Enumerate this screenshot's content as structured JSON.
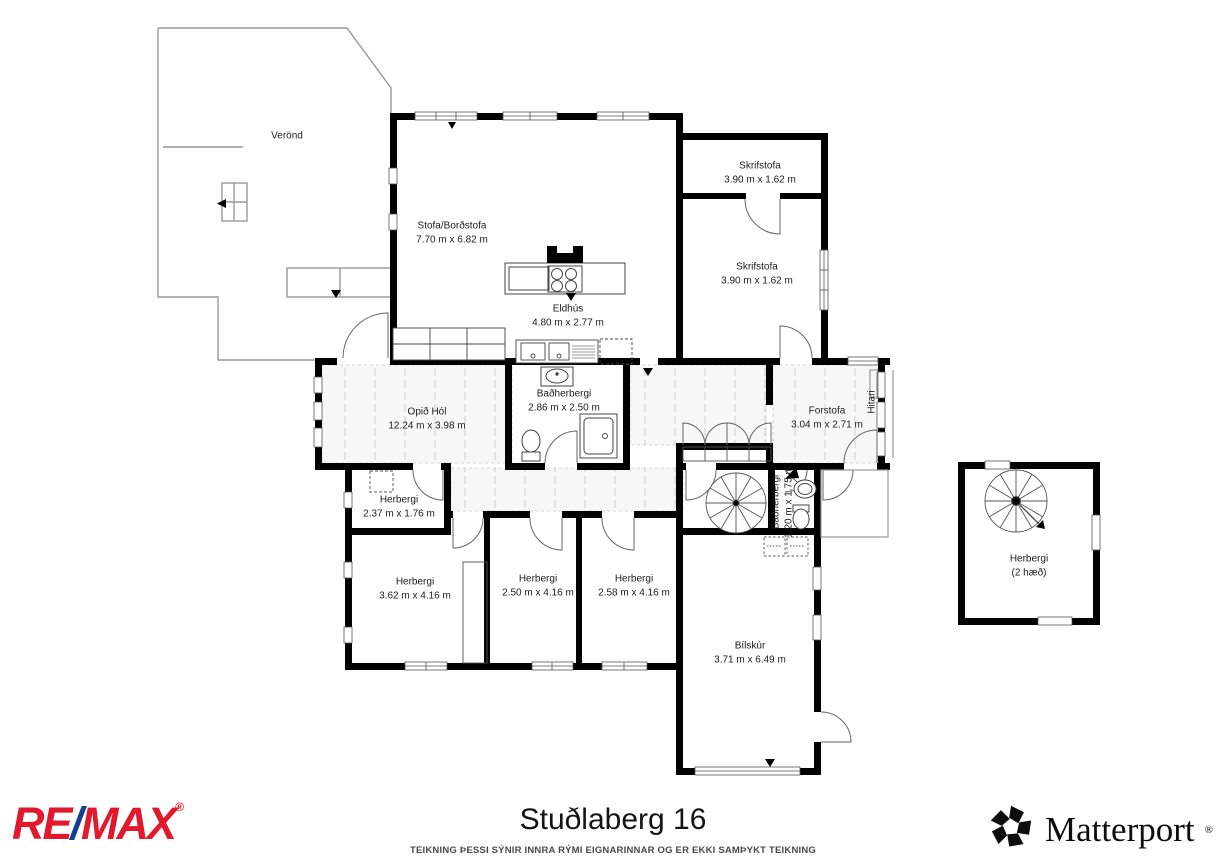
{
  "plan": {
    "rooms": {
      "verond": {
        "name": "Verönd"
      },
      "stofa": {
        "name": "Stofa/Borðstofa",
        "dims": "7.70 m x 6.82 m"
      },
      "skrifstofa1": {
        "name": "Skrifstofa",
        "dims": "3.90 m x 1.62 m"
      },
      "skrifstofa2": {
        "name": "Skrifstofa",
        "dims": "3.90 m x 1.62 m"
      },
      "eldhus": {
        "name": "Eldhús",
        "dims": "4.80 m x 2.77 m"
      },
      "opid_hol": {
        "name": "Opið Hól",
        "dims": "12.24 m x 3.98 m"
      },
      "badherbergi": {
        "name": "Baðherbergi",
        "dims": "2.86 m x 2.50 m"
      },
      "forstofa": {
        "name": "Forstofa",
        "dims": "3.04 m x 2.71 m"
      },
      "hitari": {
        "name": "Hitari"
      },
      "herbergi_small": {
        "name": "Herbergi",
        "dims": "2.37 m x 1.76 m"
      },
      "herbergi1": {
        "name": "Herbergi",
        "dims": "3.62 m x 4.16 m"
      },
      "herbergi2": {
        "name": "Herbergi",
        "dims": "2.50 m x 4.16 m"
      },
      "herbergi3": {
        "name": "Herbergi",
        "dims": "2.58 m x 4.16 m"
      },
      "badherbergi_small": {
        "name": "Baðherbergi",
        "dims": "1.20 m x 1.75 m"
      },
      "bilskur": {
        "name": "Bílskúr",
        "dims": "3.71 m x 6.49 m"
      },
      "herbergi_2haed": {
        "name": "Herbergi",
        "dims": "(2 hæð)"
      }
    }
  },
  "footer": {
    "title": "Stuðlaberg 16",
    "disclaimer": "TEIKNING ÞESSI SÝNIR INNRA RÝMI EIGNARINNAR OG ER EKKI SAMÞYKT TEIKNING",
    "remax": {
      "re": "RE",
      "slash": "/",
      "max": "MAX",
      "registered": "®",
      "color_red": "#e2182d",
      "color_blue": "#163e8f"
    },
    "matterport": {
      "name": "Matterport",
      "registered": "®",
      "color": "#0d0d0d"
    }
  }
}
